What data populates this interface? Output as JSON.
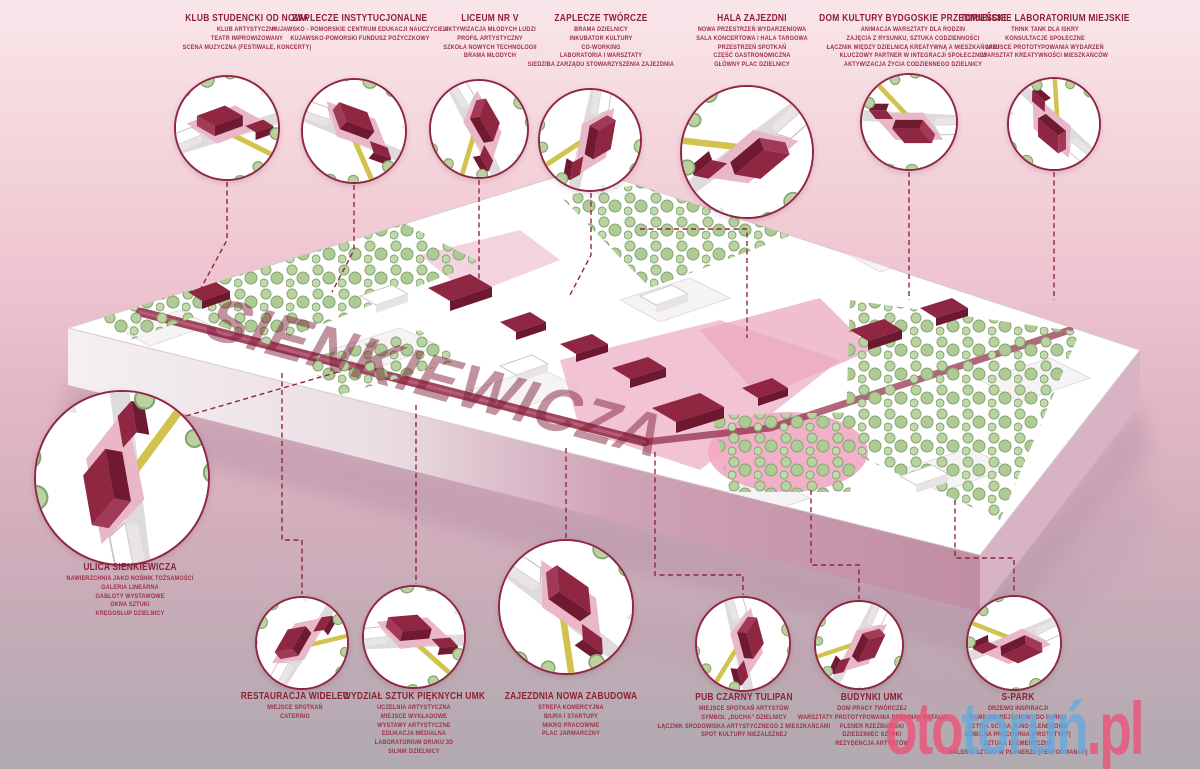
{
  "map": {
    "street_label": "SIENKIEWICZA"
  },
  "watermark": {
    "part1": "oto",
    "part2": "toruń",
    "part3": ".pl"
  },
  "colors": {
    "accent": "#8f2742",
    "label_red": "#8c2034",
    "tree_green": "#b9d3a0",
    "pink_zone": "#f2a7c3",
    "watermark_pink": "#ec5378",
    "watermark_blue": "#66a9dc"
  },
  "callouts": [
    {
      "id": "klub-studencki",
      "title": "KLUB STUDENCKI OD NOWA",
      "lines": [
        "KLUB ARTYSTYCZNY",
        "TEATR IMPROWIZOWANY",
        "SCENA MUZYCZNA (FESTIWALE, KONCERTY)"
      ]
    },
    {
      "id": "zaplecze-instytucjonalne",
      "title": "ZAPLECZE INSTYTUCJONALNE",
      "lines": [
        "KUJAWSKO - POMORSKIE CENTRUM EDUKACJI NAUCZYCIELI",
        "KUJAWSKO-POMORSKI FUNDUSZ POŻYCZKOWY"
      ]
    },
    {
      "id": "liceum-nr-v",
      "title": "LICEUM NR V",
      "lines": [
        "AKTYWIZACJA MŁODYCH LUDZI",
        "PROFIL ARTYSTYCZNY",
        "SZKOŁA NOWYCH TECHNOLOGII",
        "BRAMA MŁODYCH"
      ]
    },
    {
      "id": "zaplecze-tworcze",
      "title": "ZAPLECZE TWÓRCZE",
      "lines": [
        "BRAMA DZIELNICY",
        "INKUBATOR KULTURY",
        "CO-WORKING",
        "LABORATORIA I WARSZTATY",
        "SIEDZIBA ZARZĄDU STOWARZYSZENIA ZAJEZDNIA"
      ]
    },
    {
      "id": "hala-zajezdni",
      "title": "HALA ZAJEZDNI",
      "lines": [
        "NOWA PRZESTRZEŃ WYDARZENIOWA",
        "SALA KONCERTOWA I HALA TARGOWA",
        "PRZESTRZEŃ SPOTKAŃ",
        "CZĘŚĆ GASTRONOMICZNA",
        "GŁÓWNY PLAC DZIELNICY"
      ]
    },
    {
      "id": "dom-kultury",
      "title": "DOM KULTURY BYDGOSKIE PRZEDMIEŚCIE",
      "lines": [
        "ANIMACJA WARSZTATY DLA RODZIN",
        "ZAJĘCIA Z RYSUNKU, SZTUKA CODZIENNOŚCI",
        "ŁĄCZNIK MIĘDZY DZIELNICĄ KREATYWNĄ A MIESZKAŃCAMI",
        "KLUCZOWY PARTNER W INTEGRACJI SPOŁECZNEJ",
        "AKTYWIZACJA ŻYCIA CODZIENNEGO DZIELNICY"
      ]
    },
    {
      "id": "torunskie-laboratorium",
      "title": "TORUŃSKIE LABORATORIUM MIEJSKIE",
      "lines": [
        "THINK TANK DLA ISKRY",
        "KONSULTACJE SPOŁECZNE",
        "MIEJSCE PROTOTYPOWANIA WYDARZEŃ",
        "WARSZTAT KREATYWNOŚCI MIESZKAŃCÓW"
      ]
    },
    {
      "id": "ulica-sienkiewicza",
      "title": "ULICA SIENKIEWICZA",
      "lines": [
        "NAWIERZCHNIA JAKO NOŚNIK TOŻSAMOŚCI",
        "GALERIA LINEARNA",
        "GABLOTY WYSTAWOWE",
        "OKNA SZTUKI",
        "KRĘGOSŁUP DZIELNICY"
      ]
    },
    {
      "id": "restauracja-widelec",
      "title": "RESTAURACJA WIDELEC",
      "lines": [
        "MIEJSCE SPOTKAŃ",
        "CATERING"
      ]
    },
    {
      "id": "wydzial-sztuk-pieknych",
      "title": "WYDZIAŁ SZTUK PIĘKNYCH UMK",
      "lines": [
        "UCZELNIA ARTYSTYCZNA",
        "MIEJSCE WYKŁADOWE",
        "WYSTAWY ARTYSTYCZNE",
        "EDUKACJA MEDIALNA",
        "LABORATORIUM DRUKU 3D",
        "SILNIK DZIELNICY"
      ]
    },
    {
      "id": "zajezdnia-nowa-zabudowa",
      "title": "ZAJEZDNIA NOWA ZABUDOWA",
      "lines": [
        "STREFA KOMERCYJNA",
        "BIURA I STARTUPY",
        "MIKRO PRACOWNIE",
        "PLAC JARMARCZNY"
      ]
    },
    {
      "id": "pub-czarny-tulipan",
      "title": "PUB CZARNY TULIPAN",
      "lines": [
        "MIEJSCE SPOTKAŃ ARTYSTÓW",
        "SYMBOL „DUCHA” DZIELNICY",
        "ŁĄCZNIK ŚRODOWISKA ARTYSTYCZNEGO Z MIESZKAŃCAMI",
        "SPOT KULTURY NIEZALEŻNEJ"
      ]
    },
    {
      "id": "budynki-umk",
      "title": "BUDYNKI UMK",
      "lines": [
        "DOM PRACY TWÓRCZEJ",
        "WARSZTATY PROTOTYPOWANIA DREWNA I METALU",
        "PLENER RZEŹBIARSKI",
        "DZIEDZINIEC SZTUKI",
        "REZYDENCJA ARTYSTÓW"
      ]
    },
    {
      "id": "s-park",
      "title": "S-PARK",
      "lines": [
        "DRZEWO INSPIRACJI",
        "PAWILON WEJŚCIOWY DO PARKU",
        "LETNIA SCENA, KINO PLENEROWE",
        "MOBILNA PRACOWNIA (PROTOTYPY)",
        "SZTUKA EFEMERYCZNA",
        "GALERIA SZTUKI W PLENERZE (PERFORMANCE)"
      ]
    }
  ]
}
